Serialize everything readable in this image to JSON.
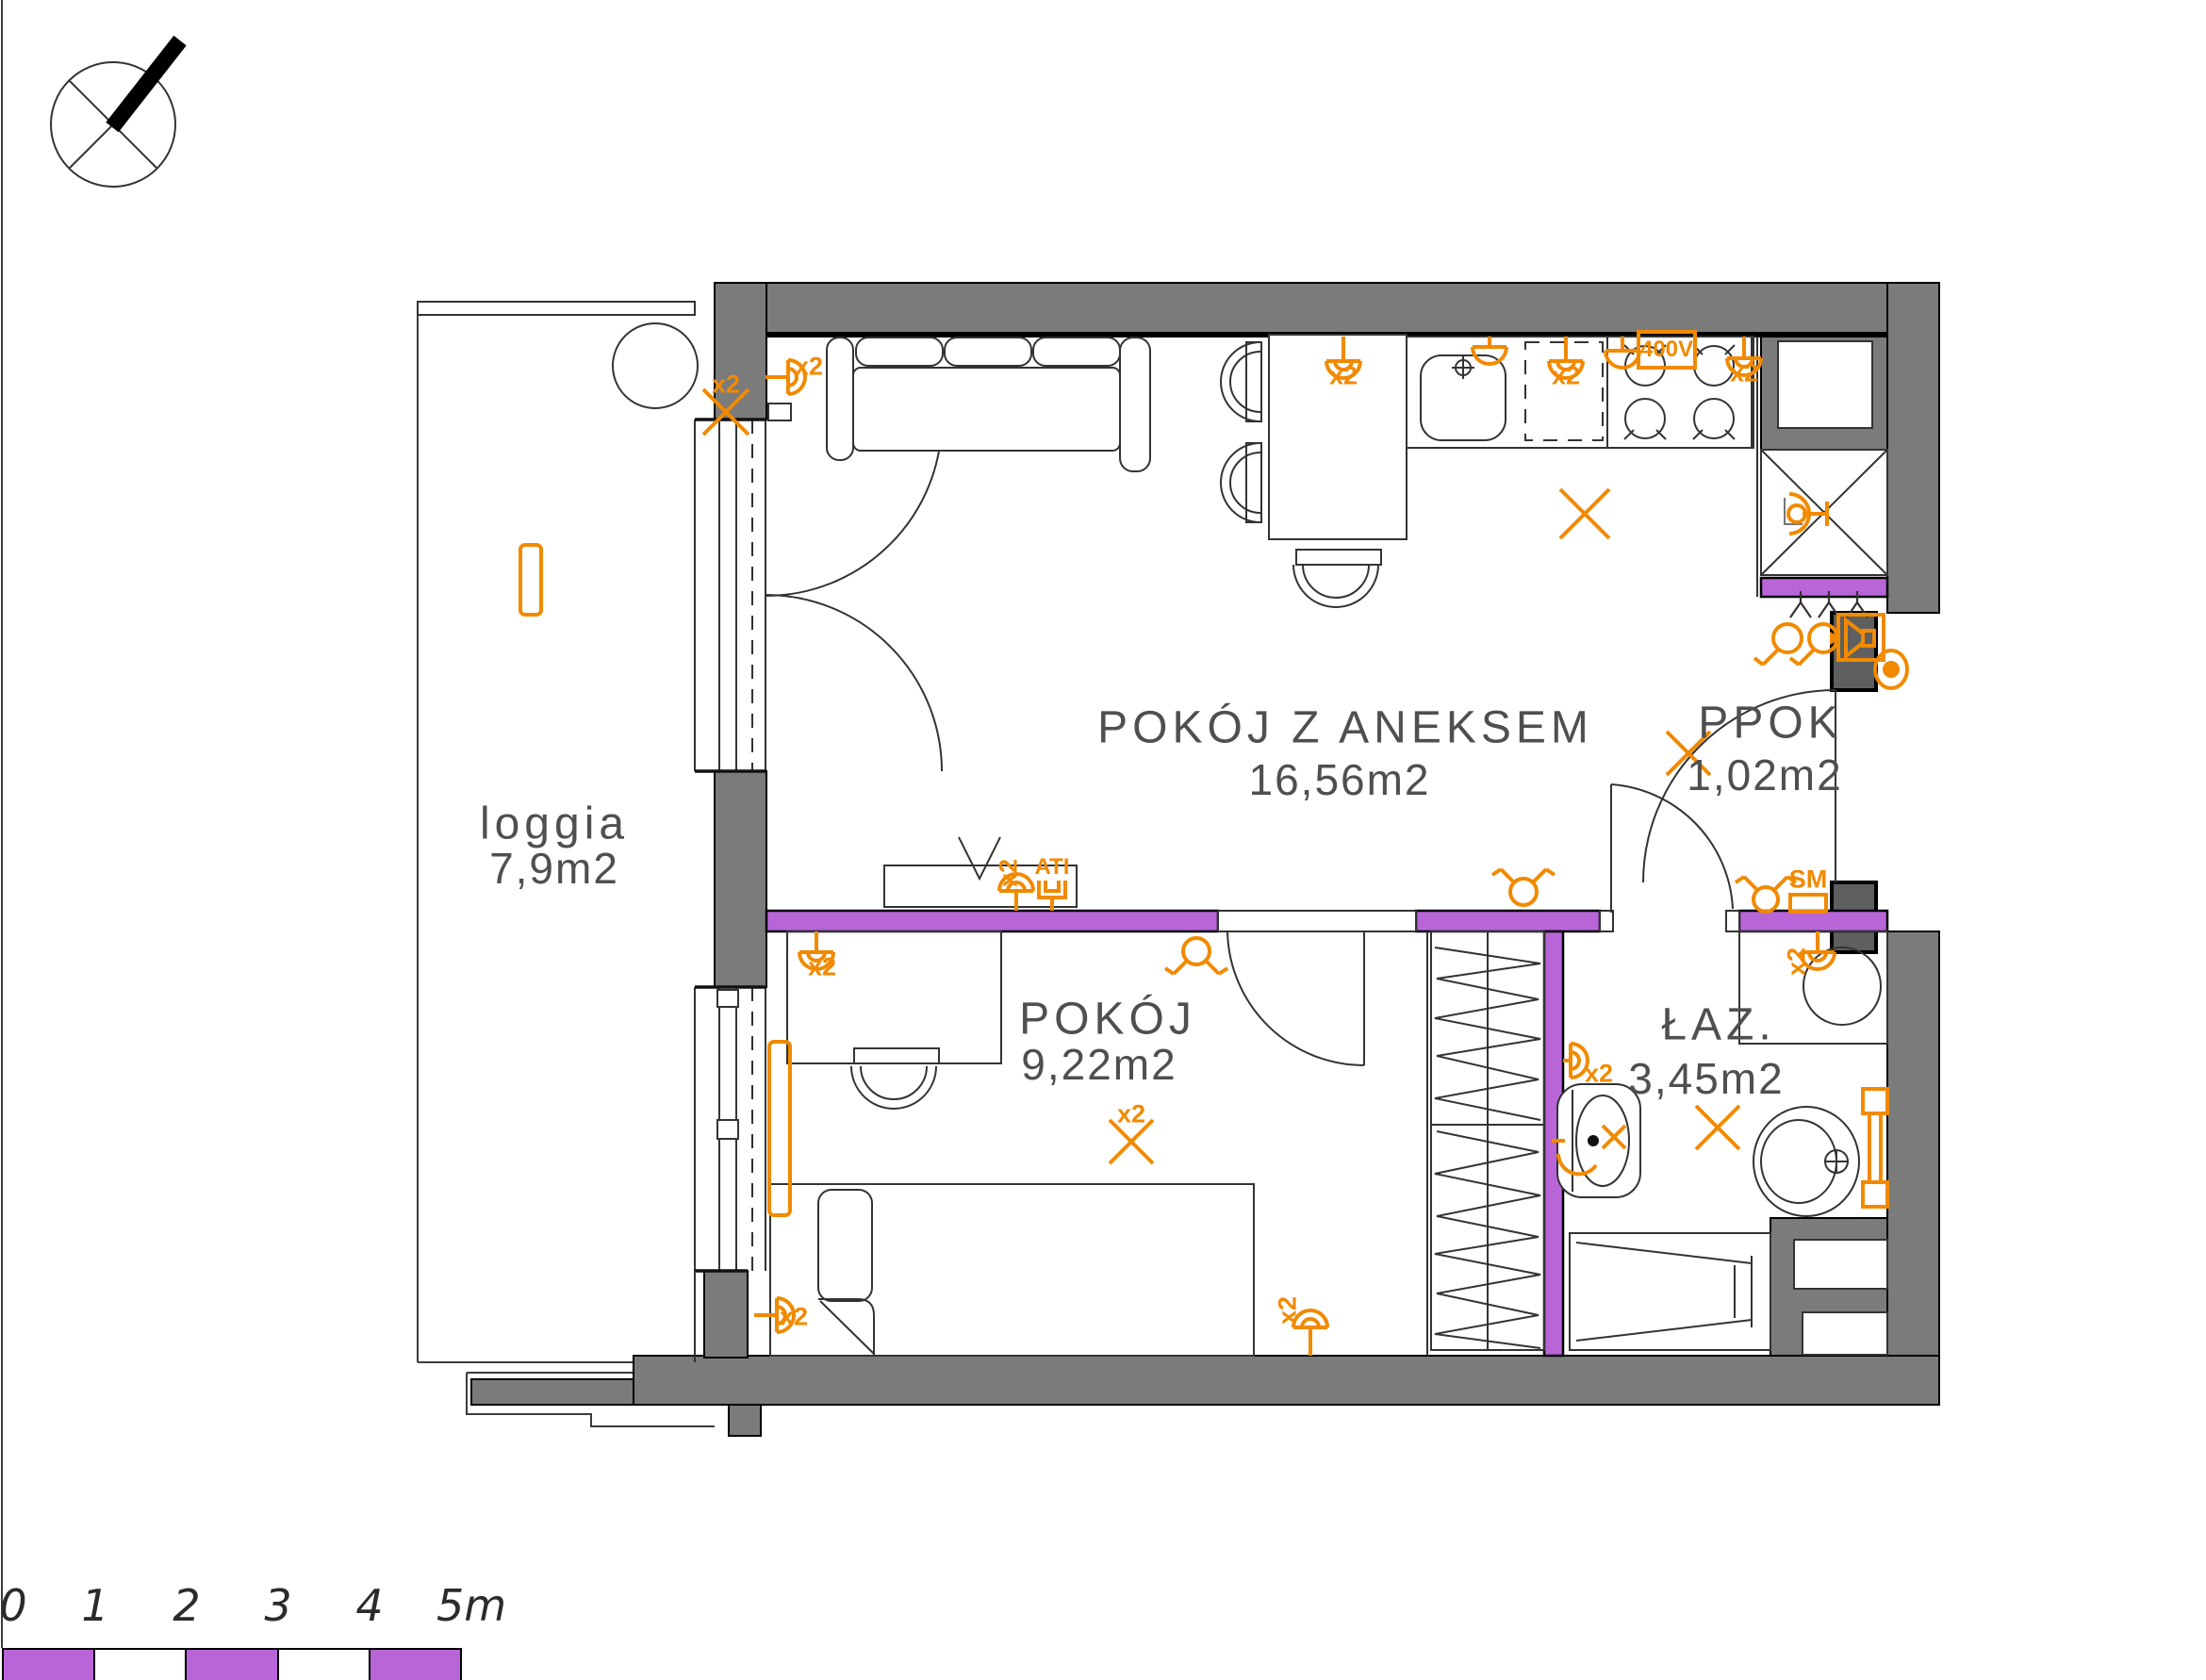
{
  "rooms": {
    "loggia": {
      "name": "loggia",
      "area": "7,9m2"
    },
    "anex": {
      "name": "POKÓJ Z ANEKSEM",
      "area": "16,56m2"
    },
    "ppok": {
      "name": "PPOK",
      "area": "1,02m2"
    },
    "pokoj": {
      "name": "POKÓJ",
      "area": "9,22m2"
    },
    "laz": {
      "name": "ŁAZ.",
      "area": "3,45m2"
    }
  },
  "sym": {
    "x2": "x2",
    "v400": "400V",
    "ati": "ATI",
    "sm": "SM"
  },
  "scale": {
    "labels": [
      "0",
      "1",
      "2",
      "3",
      "4",
      "5m"
    ]
  },
  "colors": {
    "wall_gray": "#7b7b7b",
    "accent_purple": "#b865d8",
    "electrical_orange": "#f18a00"
  }
}
